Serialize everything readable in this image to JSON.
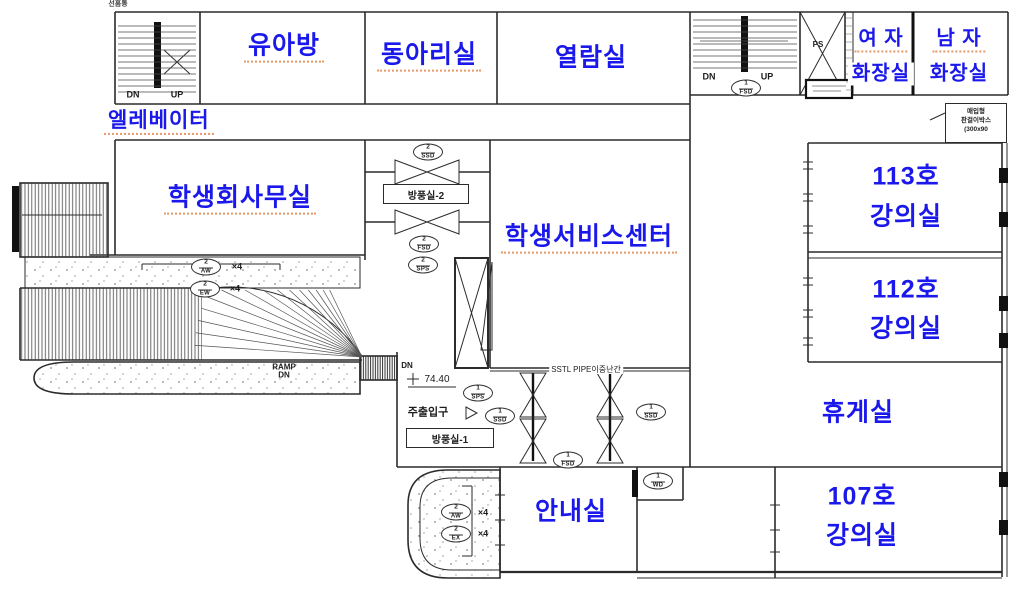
{
  "colors": {
    "label_blue": "#1a18ea",
    "squiggle": "#e8996a",
    "line": "#2b2b2b"
  },
  "rooms": {
    "infant": "유아방",
    "club": "동아리실",
    "reading": "열람실",
    "womens_restroom_line1": "여 자",
    "womens_restroom_line2": "화장실",
    "mens_restroom_line1": "남 자",
    "mens_restroom_line2": "화장실",
    "elevator": "엘레베이터",
    "student_council_office": "학생회사무실",
    "student_service_center": "학생서비스센터",
    "room113_line1": "113호",
    "room113_line2": "강의실",
    "room112_line1": "112호",
    "room112_line2": "강의실",
    "lounge": "휴게실",
    "room107_line1": "107호",
    "room107_line2": "강의실",
    "information": "안내실"
  },
  "annotations": {
    "stair1_dn": "DN",
    "stair1_up": "UP",
    "stair2_dn": "DN",
    "stair2_up": "UP",
    "entrance_dn": "DN",
    "ramp_line1": "RAMP",
    "ramp_line2": "DN",
    "pipe_shaft": "PS",
    "vestibule2": "방풍실-2",
    "vestibule1": "방풍실-1",
    "main_entrance": "주출입구",
    "level": "74.40",
    "railing": "SSTL PIPE이중난간",
    "downspout": "선홈통",
    "times4": "×4",
    "banner_line1": "매입형",
    "banner_line2": "판걸이박스",
    "banner_line3": "(300x90"
  },
  "symbols": [
    {
      "num": "2",
      "code": "SSD"
    },
    {
      "num": "2",
      "code": "FSD"
    },
    {
      "num": "2",
      "code": "SPS"
    },
    {
      "num": "2",
      "code": "AW"
    },
    {
      "num": "2",
      "code": "EW"
    },
    {
      "num": "1",
      "code": "SPS"
    },
    {
      "num": "1",
      "code": "SSD"
    },
    {
      "num": "1",
      "code": "FSD"
    },
    {
      "num": "1",
      "code": "FSD"
    },
    {
      "num": "1",
      "code": "SSD"
    },
    {
      "num": "1",
      "code": "WD"
    },
    {
      "num": "2",
      "code": "AW"
    },
    {
      "num": "2",
      "code": "EX"
    }
  ]
}
